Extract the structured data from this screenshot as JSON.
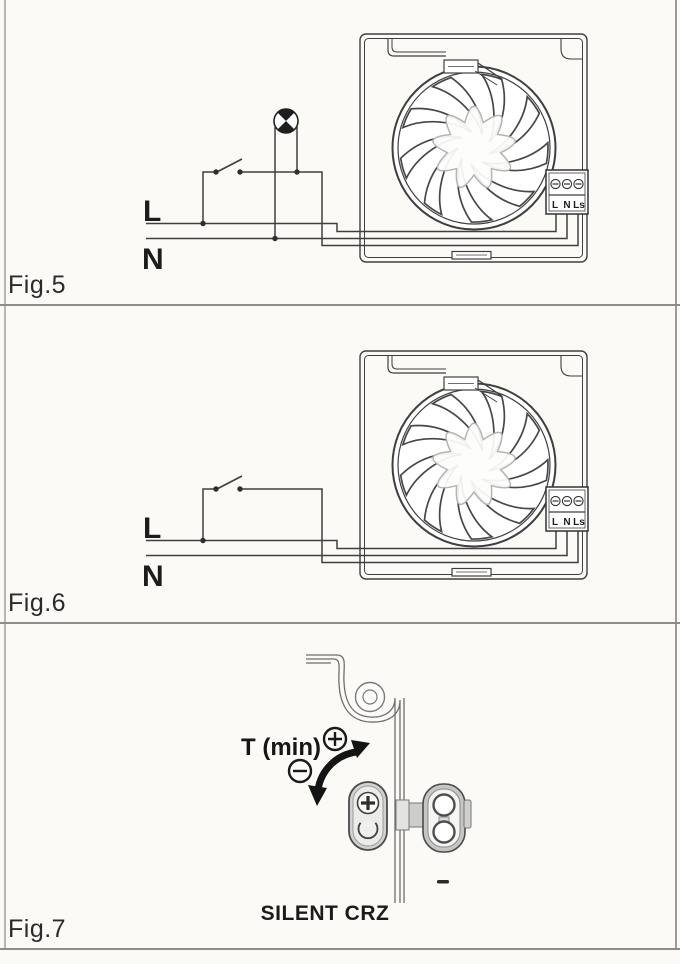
{
  "page": {
    "background": "#fbfaf6",
    "divider_color": "#8c8c8c"
  },
  "colors": {
    "ink": "#3f3f3f",
    "text": "#1c1c1c",
    "gray_part": "#d2d2d2"
  },
  "figures": {
    "fig5": {
      "label": "Fig.5",
      "line_labels": [
        "L",
        "N"
      ],
      "terminals": [
        "L",
        "N",
        "Ls"
      ],
      "has_lamp": true
    },
    "fig6": {
      "label": "Fig.6",
      "line_labels": [
        "L",
        "N"
      ],
      "terminals": [
        "L",
        "N",
        "Ls"
      ],
      "has_lamp": false
    },
    "fig7": {
      "label": "Fig.7",
      "timer_label": "T (min)",
      "increase_symbol": "+",
      "decrease_symbol": "−",
      "product_name": "SILENT CRZ"
    }
  }
}
